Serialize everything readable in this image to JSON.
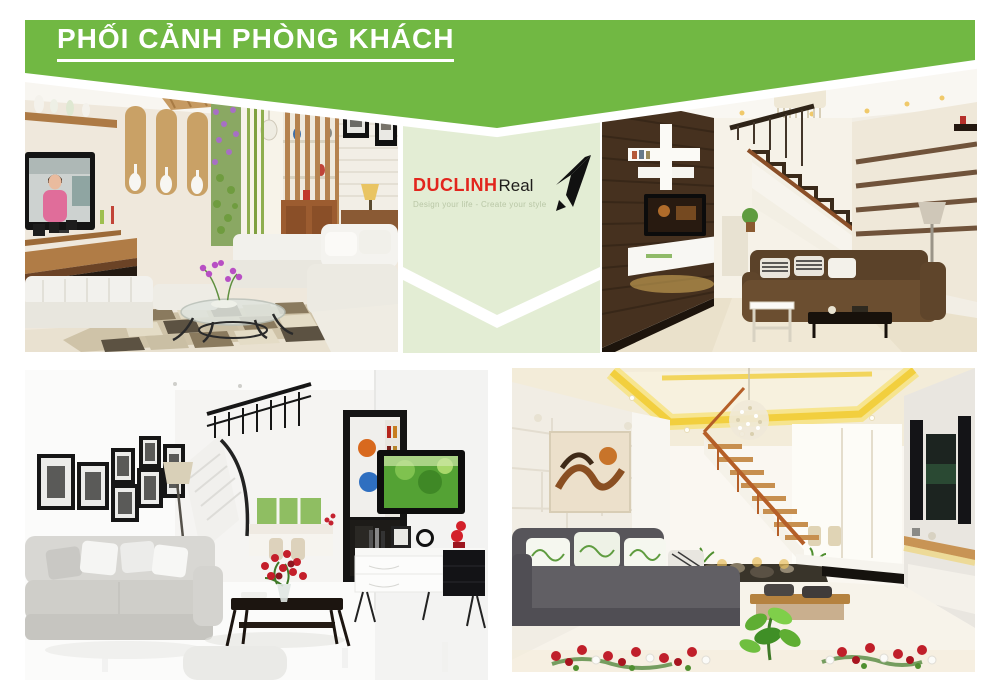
{
  "page": {
    "width": 1000,
    "height": 697,
    "background": "#ffffff"
  },
  "header": {
    "title": "PHỐI CẢNH PHÒNG KHÁCH"
  },
  "logo": {
    "brand": "DUCLINH",
    "suffix": "Real",
    "tagline": "Design your life - Create your style",
    "arrow_icon": "paper-dart-arrow"
  },
  "colors": {
    "green": "#71b843",
    "pale": "#e3edd4",
    "red": "#e2251d",
    "ink": "#1f1d1b",
    "tagline": "#b9c7a6",
    "white": "#ffffff"
  },
  "photos": [
    {
      "id": "top-left",
      "alt": "Living room render: white sectional sofa, wall TV with presenter in pink, lit display niches with vases, vertical garden, wooden slat partition, glass coffee table with purple orchid, checkered rug"
    },
    {
      "id": "top-right",
      "alt": "Living room render: dark wood slat feature wall with TV and white shelves, chandelier, staircase with wooden handrail, striped-panel wall, brown corner sofa with striped cushions"
    },
    {
      "id": "bottom-left",
      "alt": "Bright white living room render: grey fabric sofa, black framed photo gallery wall, stairs with black railing, bar display cabinet with bottles, wall TV with green screen, black coffee table with red roses, white sideboard"
    },
    {
      "id": "bottom-right",
      "alt": "Living room render: yellow cove ceiling lighting, crystal chandelier, abstract painting on stone wall, open wooden staircase over rock garden, dark grey sofa with leaf-print cushions, red and white flowers in the foreground"
    }
  ]
}
